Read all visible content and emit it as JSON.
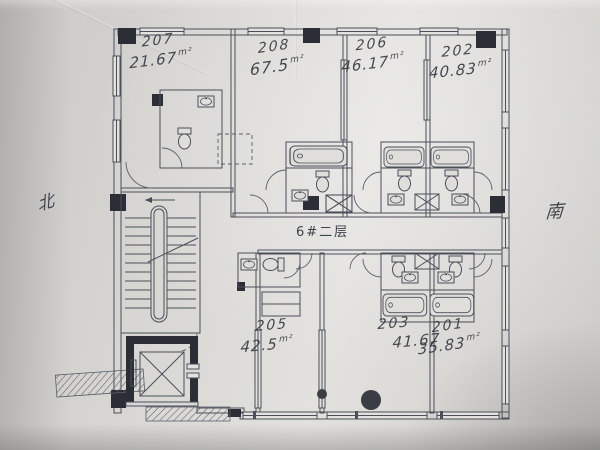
{
  "colors": {
    "paper": "#d8d7d4",
    "paper_light": "#e3e2df",
    "ink": "#4a4f5a",
    "ink_dark": "#2b2e35",
    "handwriting": "#35383f"
  },
  "plan": {
    "floor_label": "6#二层",
    "compass": {
      "left": "北",
      "right": "南"
    },
    "rooms": [
      {
        "number": "207",
        "area": "21.67",
        "unit": "m²"
      },
      {
        "number": "208",
        "area": "67.5",
        "unit": "m²"
      },
      {
        "number": "206",
        "area": "46.17",
        "unit": "m²"
      },
      {
        "number": "202",
        "area": "40.83",
        "unit": "m²"
      },
      {
        "number": "205",
        "area": "42.5",
        "unit": "m²"
      },
      {
        "number": "203",
        "area": "41.67",
        "unit": ""
      },
      {
        "number": "201",
        "area": "35.83",
        "unit": "m²"
      }
    ]
  }
}
